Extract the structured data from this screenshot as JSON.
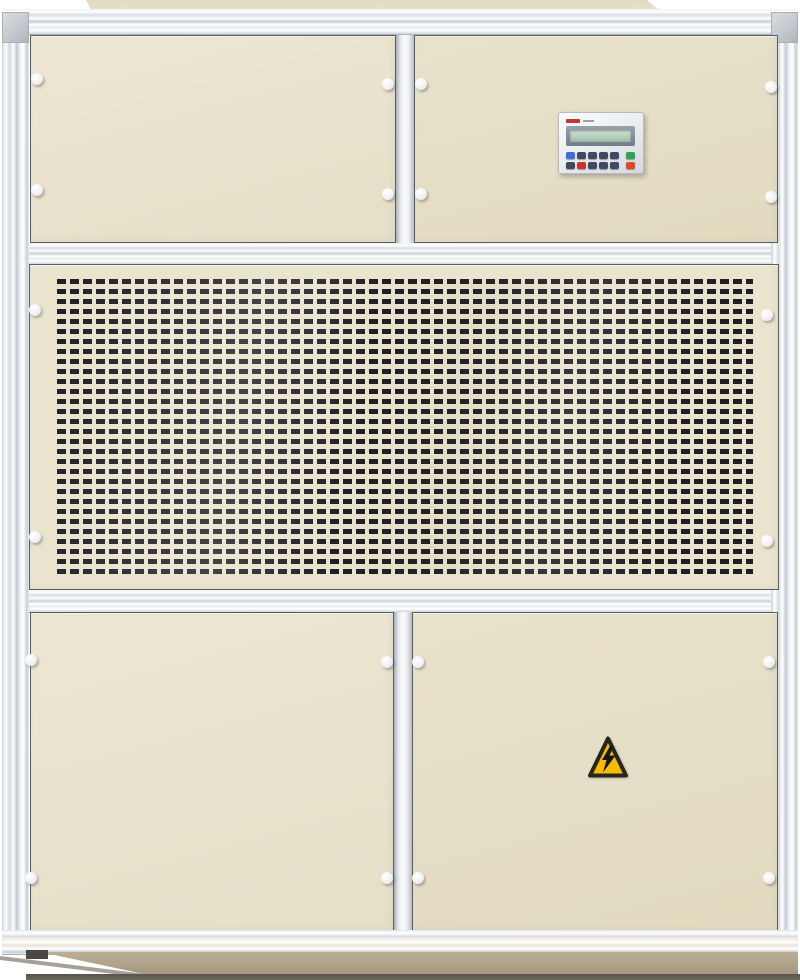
{
  "photo": {
    "subject": "Industrial packaged air-conditioning / dehumidifier cabinet, front view",
    "sections": {
      "roof_cap": "cream top cap panel",
      "top_left_panel": "upper access panel",
      "top_right_panel": "upper access panel with controller pad",
      "grille_panel": "perforated air intake grille panel",
      "bottom_left_panel": "lower access door",
      "bottom_right_panel": "lower access door with high-voltage warning decal",
      "base": "recessed tan plinth base"
    },
    "colors": {
      "panel_cream": "#e9e3cd",
      "frame_aluminum": "#eef1f4",
      "grille_slot_dark": "#1d1f24",
      "base_tan": "#b0a289",
      "warning_yellow": "#f7bc00"
    }
  },
  "controller": {
    "lcd_text": "",
    "logo_color": "#c0392b",
    "button_rows": [
      [
        "blue",
        "navy",
        "navy",
        "navy",
        "navy",
        "green"
      ],
      [
        "navy",
        "red",
        "navy",
        "navy",
        "navy",
        "orange"
      ]
    ],
    "button_colors": {
      "blue": "#3a6fd8",
      "navy": "#3e4a63",
      "green": "#2fa64e",
      "red": "#c8332e",
      "orange": "#e04a20"
    }
  },
  "warning_sticker": {
    "icon": "high-voltage-lightning",
    "triangle_fill": "#f7bc00",
    "triangle_border": "#26261f",
    "bolt_color": "#17170f"
  }
}
